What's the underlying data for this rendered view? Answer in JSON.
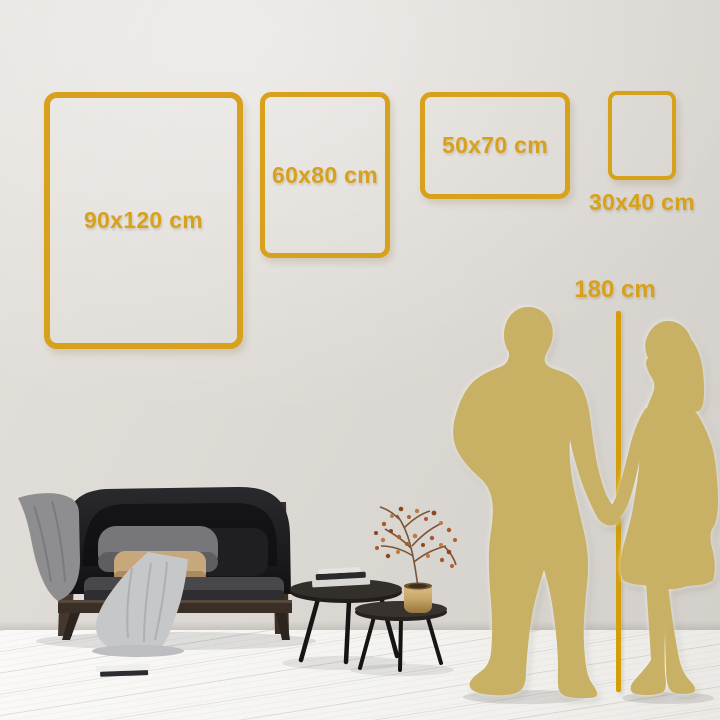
{
  "scene": {
    "description": "Wall art size comparison in living room with couple silhouette height reference",
    "people_count": 2
  },
  "size_frames": [
    {
      "label": "90x120 cm"
    },
    {
      "label": "60x80 cm"
    },
    {
      "label": "50x70 cm"
    },
    {
      "label": "30x40 cm"
    }
  ],
  "height_marker": {
    "label": "180 cm"
  },
  "colors": {
    "accent_gold": "#d8a11b",
    "marker_gold": "#d49e0b",
    "silhouette_gold": "#c8b065",
    "wall_gray": "#dedad5",
    "floor_white": "#f5f4f1",
    "sofa_black": "#1b1b1e",
    "wood_brown": "#42352b",
    "blanket_light_gray": "#c6c7c9",
    "blanket_dark_gray": "#8e8e90",
    "pillow_tan": "#c7a77c",
    "brass_vase": "#c9a869"
  }
}
